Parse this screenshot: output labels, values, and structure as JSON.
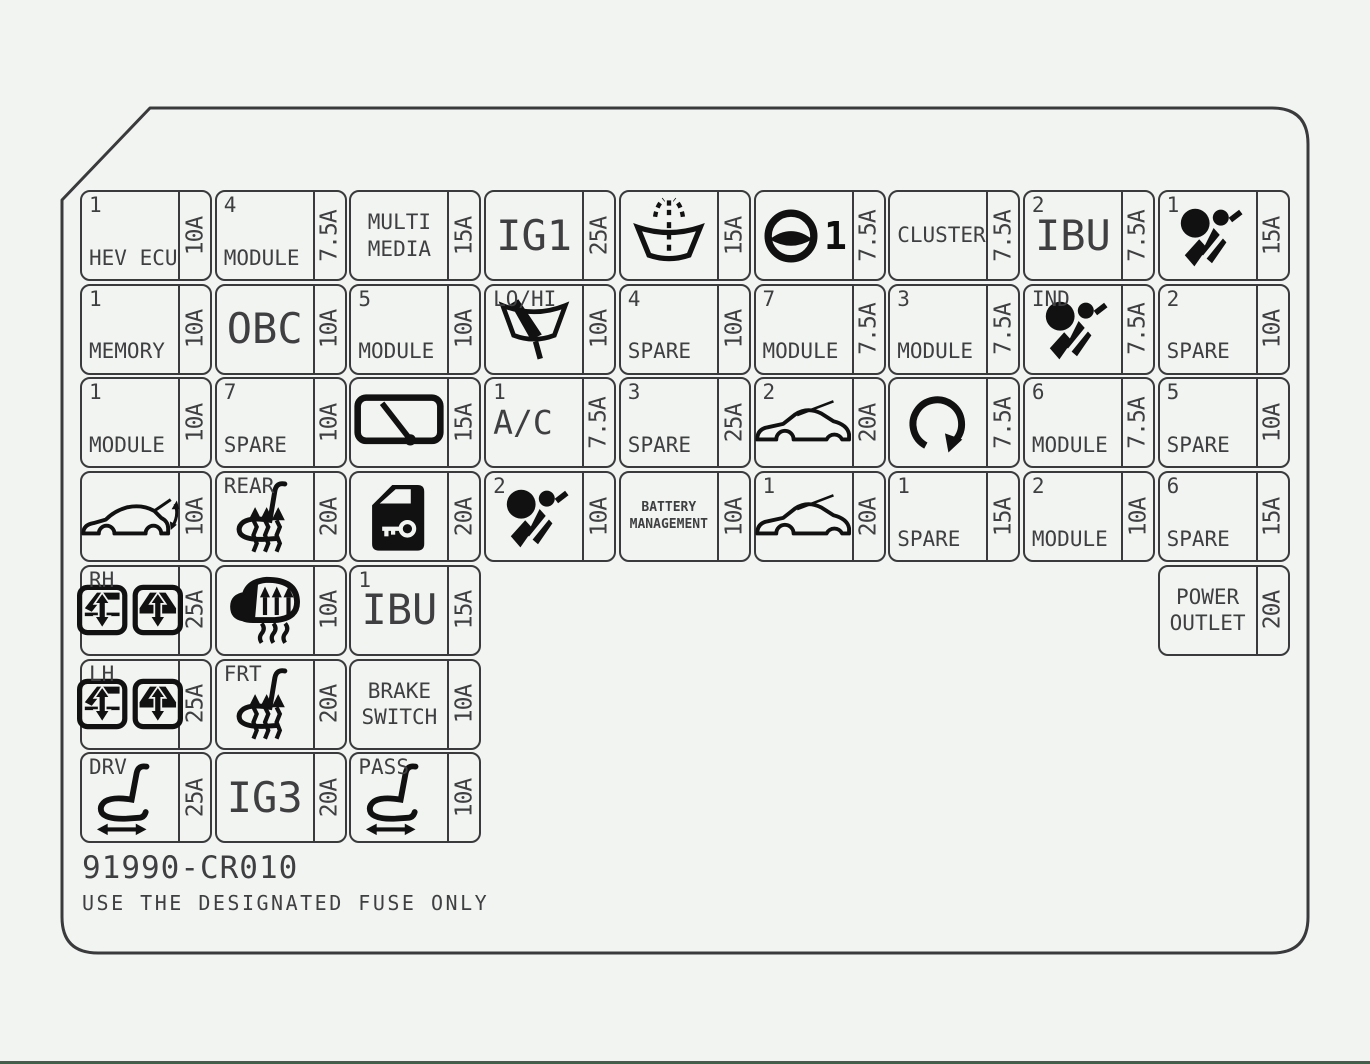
{
  "page": {
    "background": "#f2f4f2",
    "line_color": "#3a3a3c",
    "icon_color": "#111111",
    "bottom_bar_color": "#41604a"
  },
  "footer": {
    "part_number": "91990-CR010",
    "notice": "USE THE DESIGNATED FUSE ONLY"
  },
  "fusebox": {
    "rows": [
      {
        "row": 1,
        "cells": [
          {
            "col": 1,
            "tag": "1",
            "lines": [
              "HEV ECU"
            ],
            "amp": "10A"
          },
          {
            "col": 2,
            "tag": "4",
            "lines": [
              "MODULE"
            ],
            "amp": "7.5A"
          },
          {
            "col": 3,
            "lines": [
              "MULTI",
              "MEDIA"
            ],
            "align": "center",
            "valign": "middle",
            "amp": "15A"
          },
          {
            "col": 4,
            "lines": [
              "IG1"
            ],
            "size": "big",
            "align": "center",
            "valign": "middle",
            "amp": "25A"
          },
          {
            "col": 5,
            "icon": "windshield-washer-icon",
            "amp": "15A"
          },
          {
            "col": 6,
            "icon": "steering-wheel-icon",
            "icon_suffix": "1",
            "amp": "7.5A"
          },
          {
            "col": 7,
            "lines": [
              "CLUSTER"
            ],
            "valign": "middle",
            "amp": "7.5A"
          },
          {
            "col": 8,
            "tag": "2",
            "lines": [
              "IBU"
            ],
            "size": "big",
            "align": "center",
            "valign": "middle",
            "amp": "7.5A"
          },
          {
            "col": 9,
            "tag": "1",
            "icon": "airbag-icon",
            "amp": "15A"
          }
        ]
      },
      {
        "row": 2,
        "cells": [
          {
            "col": 1,
            "tag": "1",
            "lines": [
              "MEMORY"
            ],
            "amp": "10A"
          },
          {
            "col": 2,
            "lines": [
              "OBC"
            ],
            "size": "big",
            "align": "center",
            "valign": "middle",
            "amp": "10A"
          },
          {
            "col": 3,
            "tag": "5",
            "lines": [
              "MODULE"
            ],
            "amp": "10A"
          },
          {
            "col": 4,
            "tag": "LO/HI",
            "icon": "wiper-icon",
            "amp": "10A"
          },
          {
            "col": 5,
            "tag": "4",
            "lines": [
              "SPARE"
            ],
            "amp": "10A"
          },
          {
            "col": 6,
            "tag": "7",
            "lines": [
              "MODULE"
            ],
            "amp": "7.5A"
          },
          {
            "col": 7,
            "tag": "3",
            "lines": [
              "MODULE"
            ],
            "amp": "7.5A"
          },
          {
            "col": 8,
            "tag": "IND",
            "icon": "airbag-icon",
            "amp": "7.5A"
          },
          {
            "col": 9,
            "tag": "2",
            "lines": [
              "SPARE"
            ],
            "amp": "10A"
          }
        ]
      },
      {
        "row": 3,
        "cells": [
          {
            "col": 1,
            "tag": "1",
            "lines": [
              "MODULE"
            ],
            "amp": "10A"
          },
          {
            "col": 2,
            "tag": "7",
            "lines": [
              "SPARE"
            ],
            "amp": "10A"
          },
          {
            "col": 3,
            "icon": "rear-wiper-icon",
            "amp": "15A"
          },
          {
            "col": 4,
            "tag": "1",
            "lines": [
              "A/C"
            ],
            "size": "medium",
            "valign": "middle",
            "amp": "7.5A"
          },
          {
            "col": 5,
            "tag": "3",
            "lines": [
              "SPARE"
            ],
            "amp": "25A"
          },
          {
            "col": 6,
            "tag": "2",
            "icon": "hood-open-car-icon",
            "amp": "20A"
          },
          {
            "col": 7,
            "icon": "rotate-icon",
            "amp": "7.5A"
          },
          {
            "col": 8,
            "tag": "6",
            "lines": [
              "MODULE"
            ],
            "amp": "7.5A"
          },
          {
            "col": 9,
            "tag": "5",
            "lines": [
              "SPARE"
            ],
            "amp": "10A"
          }
        ]
      },
      {
        "row": 4,
        "cells": [
          {
            "col": 1,
            "icon": "tailgate-car-icon",
            "amp": "10A"
          },
          {
            "col": 2,
            "tag": "REAR",
            "icon": "heated-seat-icon",
            "amp": "20A"
          },
          {
            "col": 3,
            "icon": "door-lock-key-icon",
            "amp": "20A"
          },
          {
            "col": 4,
            "tag": "2",
            "icon": "airbag-icon",
            "amp": "10A"
          },
          {
            "col": 5,
            "lines": [
              "BATTERY",
              "MANAGEMENT"
            ],
            "size": "small",
            "align": "center",
            "valign": "middle",
            "amp": "10A"
          },
          {
            "col": 6,
            "tag": "1",
            "icon": "hood-open-car-icon",
            "amp": "20A"
          },
          {
            "col": 7,
            "tag": "1",
            "lines": [
              "SPARE"
            ],
            "amp": "15A"
          },
          {
            "col": 8,
            "tag": "2",
            "lines": [
              "MODULE"
            ],
            "amp": "10A"
          },
          {
            "col": 9,
            "tag": "6",
            "lines": [
              "SPARE"
            ],
            "amp": "15A"
          }
        ]
      },
      {
        "row": 5,
        "cells": [
          {
            "col": 1,
            "tag": "RH",
            "icon": "power-window-icon",
            "amp": "25A"
          },
          {
            "col": 2,
            "icon": "heated-steering-icon",
            "amp": "10A"
          },
          {
            "col": 3,
            "tag": "1",
            "lines": [
              "IBU"
            ],
            "size": "big",
            "align": "center",
            "valign": "middle",
            "amp": "15A"
          },
          {
            "col": 9,
            "lines": [
              "POWER",
              "OUTLET"
            ],
            "align": "center",
            "valign": "middle",
            "amp": "20A"
          }
        ]
      },
      {
        "row": 6,
        "cells": [
          {
            "col": 1,
            "tag": "LH",
            "icon": "power-window-icon",
            "amp": "25A"
          },
          {
            "col": 2,
            "tag": "FRT",
            "icon": "heated-seat-icon",
            "amp": "20A"
          },
          {
            "col": 3,
            "lines": [
              "BRAKE",
              "SWITCH"
            ],
            "align": "center",
            "valign": "middle",
            "amp": "10A"
          }
        ]
      },
      {
        "row": 7,
        "cells": [
          {
            "col": 1,
            "tag": "DRV",
            "icon": "power-seat-icon",
            "amp": "25A"
          },
          {
            "col": 2,
            "lines": [
              "IG3"
            ],
            "size": "big",
            "align": "center",
            "valign": "middle",
            "amp": "20A"
          },
          {
            "col": 3,
            "tag": "PASS",
            "icon": "power-seat-icon",
            "amp": "10A"
          }
        ]
      }
    ]
  }
}
